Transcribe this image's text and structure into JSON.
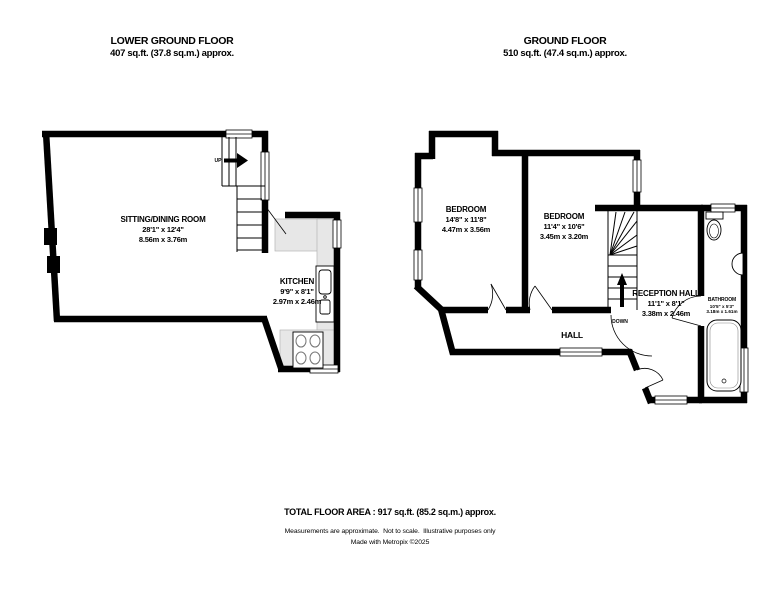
{
  "colors": {
    "background": "#ffffff",
    "wall": "#000000",
    "counter": "#e7e7e7"
  },
  "floors": [
    {
      "title": "LOWER GROUND FLOOR",
      "area": "407 sq.ft. (37.8 sq.m.) approx.",
      "rooms": [
        {
          "name": "SITTING/DINING ROOM",
          "imperial": "28'1\" x 12'4\"",
          "metric": "8.56m x 3.76m"
        },
        {
          "name": "KITCHEN",
          "imperial": "9'9\" x 8'1\"",
          "metric": "2.97m x 2.46m"
        }
      ],
      "labels": {
        "stairs_direction": "UP"
      }
    },
    {
      "title": "GROUND FLOOR",
      "area": "510 sq.ft. (47.4 sq.m.) approx.",
      "rooms": [
        {
          "name": "BEDROOM",
          "imperial": "14'8\" x 11'8\"",
          "metric": "4.47m x 3.56m"
        },
        {
          "name": "BEDROOM",
          "imperial": "11'4\" x 10'6\"",
          "metric": "3.45m x 3.20m"
        },
        {
          "name": "RECEPTION HALL",
          "imperial": "11'1\" x 8'1\"",
          "metric": "3.38m x 2.46m"
        },
        {
          "name": "BATHROOM",
          "imperial": "10'5\" x 5'3\"",
          "metric": "3.18m x 1.61m"
        },
        {
          "name": "HALL"
        }
      ],
      "labels": {
        "stairs_direction": "DOWN"
      }
    }
  ],
  "fixtures": [
    "staircase-up",
    "staircase-down",
    "kitchen-counter",
    "kitchen-sink",
    "kitchen-hob",
    "toilet",
    "wash-basin",
    "bathtub"
  ],
  "footer": {
    "total": "TOTAL FLOOR AREA : 917 sq.ft. (85.2 sq.m.) approx.",
    "disclaimer": "Measurements are approximate.  Not to scale.  Illustrative purposes only",
    "credit": "Made with Metropix ©2025"
  }
}
